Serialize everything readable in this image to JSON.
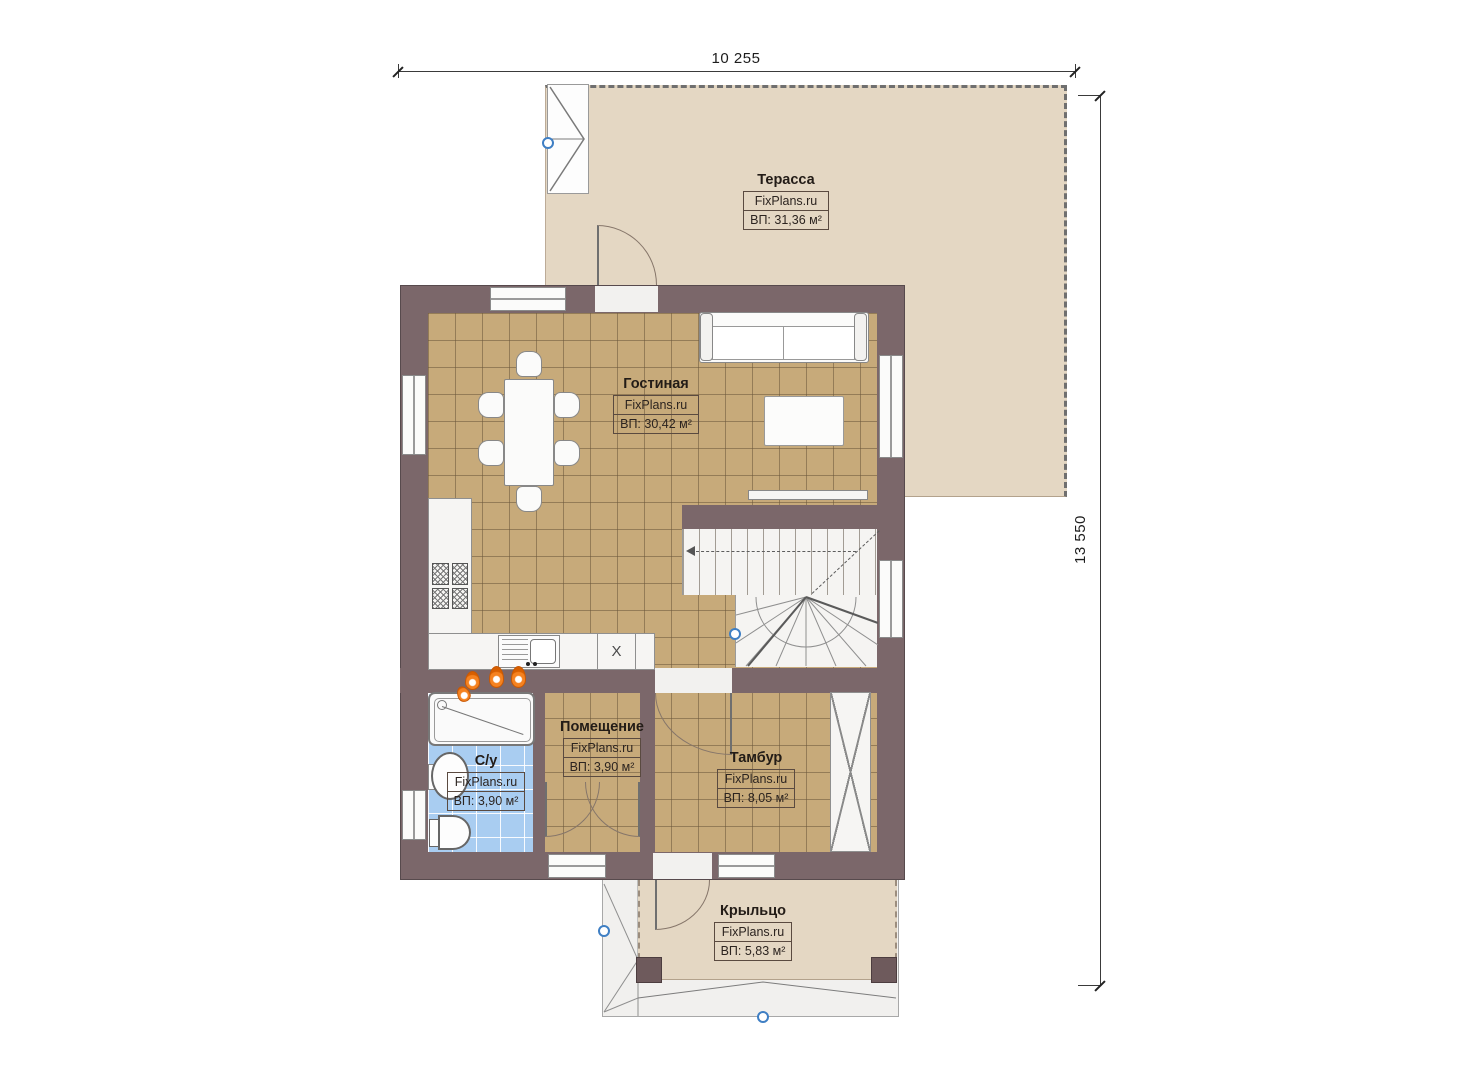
{
  "dimensions": {
    "top": "10 255",
    "right": "13 550"
  },
  "rooms": [
    {
      "key": "terrace",
      "name": "Терасса",
      "watermark": "FixPlans.ru",
      "area": "ВП: 31,36 м²"
    },
    {
      "key": "living",
      "name": "Гостиная",
      "watermark": "FixPlans.ru",
      "area": "ВП: 30,42 м²"
    },
    {
      "key": "utility",
      "name": "Помещение",
      "watermark": "FixPlans.ru",
      "area": "ВП: 3,90 м²"
    },
    {
      "key": "bathroom",
      "name": "С/у",
      "watermark": "FixPlans.ru",
      "area": "ВП: 3,90 м²"
    },
    {
      "key": "vestibule",
      "name": "Тамбур",
      "watermark": "FixPlans.ru",
      "area": "ВП: 8,05 м²"
    },
    {
      "key": "porch",
      "name": "Крыльцо",
      "watermark": "FixPlans.ru",
      "area": "ВП: 5,83 м²"
    }
  ],
  "fixtures": {
    "dishwasher_mark": "X"
  },
  "colors": {
    "wall": "#7b676a",
    "floor_tile": "#c7aa7a",
    "terrace_deck": "#e4d7c3",
    "bathroom_tile": "#a9cdf1",
    "level_marker": "#3f7fc4",
    "flame": "#f58220"
  }
}
